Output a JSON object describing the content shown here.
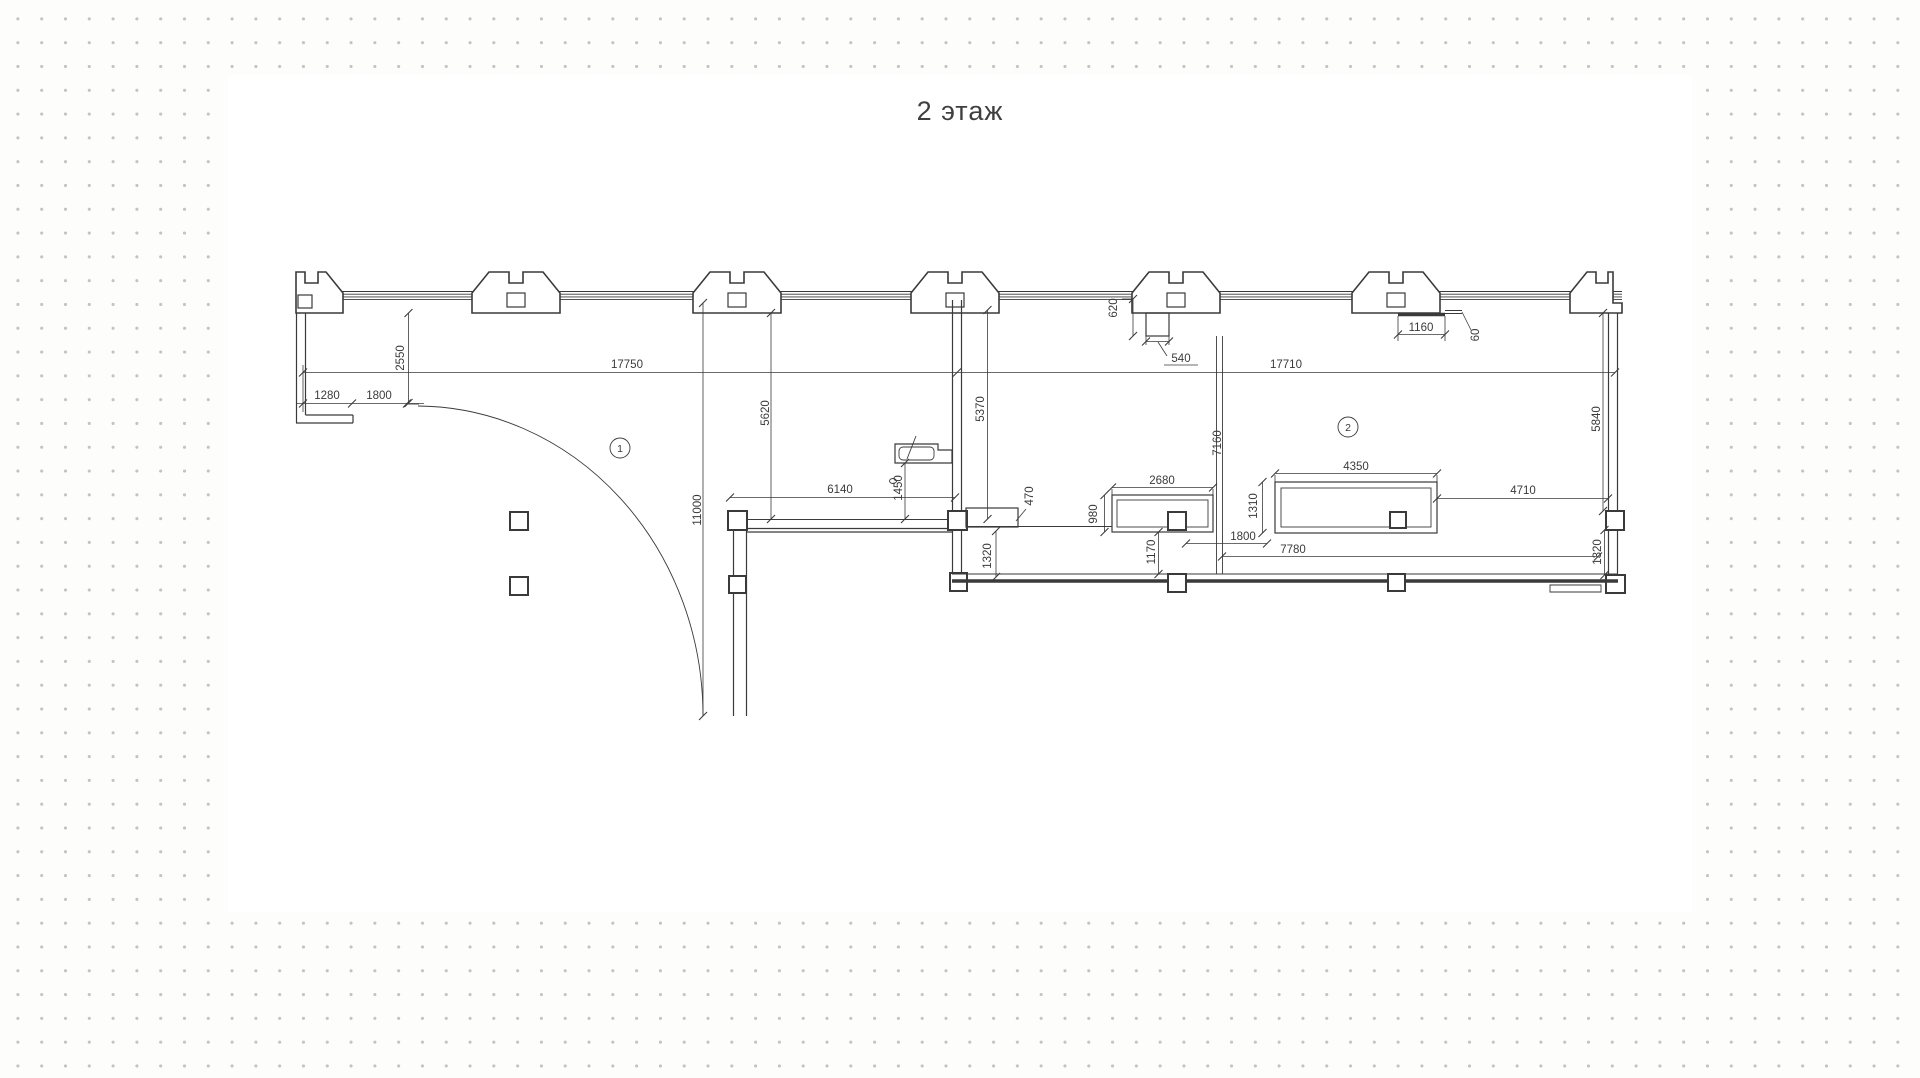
{
  "title": "2 этаж",
  "colors": {
    "line": "#3a3a3a",
    "dot": "#c3c3c3",
    "canvas": "#ffffff",
    "background": "#fdfdfc"
  },
  "rooms": [
    {
      "label": "1"
    },
    {
      "label": "2"
    }
  ],
  "dims": {
    "d2550": "2550",
    "d1280": "1280",
    "d1800_left": "1800",
    "d17750": "17750",
    "d17710": "17710",
    "d5620": "5620",
    "d11000": "11000",
    "d6140": "6140",
    "d1450": "1450",
    "d5370": "5370",
    "d470": "470",
    "d620": "620",
    "d540": "540",
    "d1160": "1160",
    "d60": "60",
    "d7160": "7160",
    "d2680": "2680",
    "d980": "980",
    "d1170": "1170",
    "d4350": "4350",
    "d1310": "1310",
    "d1800_right": "1800",
    "d7780": "7780",
    "d4710": "4710",
    "d5840": "5840",
    "d1320_left": "1320",
    "d1320_right": "1320"
  }
}
